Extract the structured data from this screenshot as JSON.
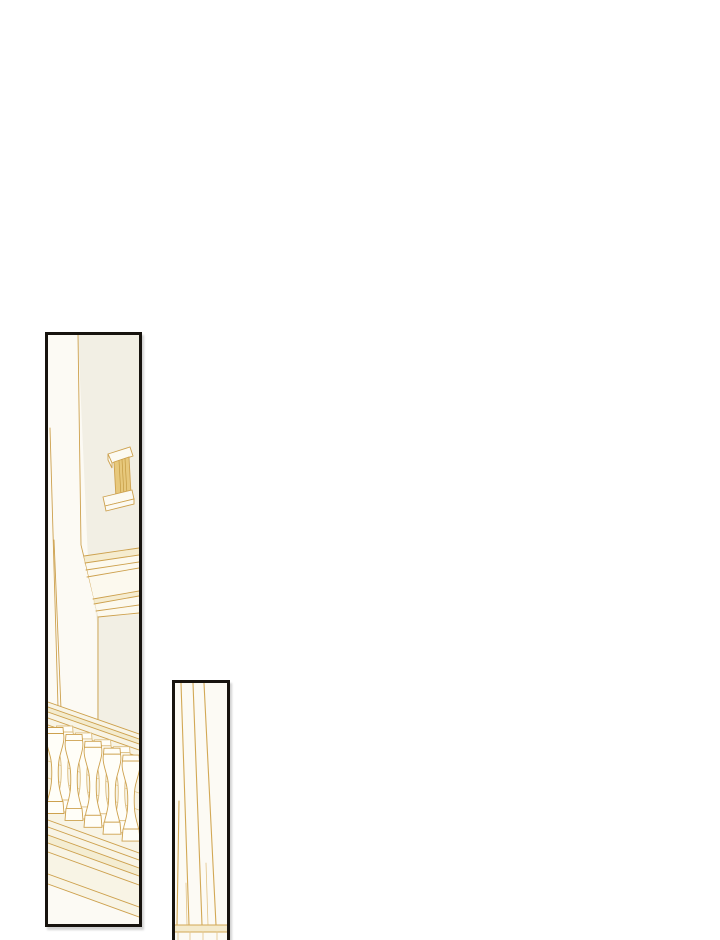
{
  "page": {
    "background": "#ffffff",
    "width": 720,
    "height": 940,
    "kind": "comic-page",
    "text_content": ""
  },
  "colors": {
    "panel_border": "#17130e",
    "gold": "#cda14e",
    "gold_light": "#e2c488",
    "wash": "#eedfb0",
    "wall": "#f2efe4",
    "zone": "#f8f4e5",
    "door": "#fcfaf4",
    "cornice_fill": "#fcf9ee",
    "baluster_fill": "#fffef8",
    "handle_fill": "#e7c87c",
    "hatch": "#c49b43"
  },
  "panels": {
    "left": {
      "alt": "door-edge-cornice-and-balustrade-line-art",
      "x": 45,
      "y": 332,
      "w": 97,
      "h": 595,
      "viewBox": "0 0 91 589",
      "stroke_default": "#cda14e",
      "width_default": 0.9,
      "art": [
        {
          "t": "poly",
          "p": "30,0 91,0 91,399 49,384 49,287 40,225",
          "f": "#f2efe4",
          "ns": true
        },
        {
          "t": "path",
          "d": "M30,0 L33,210 L50,280 L50,384"
        },
        {
          "t": "line",
          "p": [
            2,
            93,
            10,
            372
          ]
        },
        {
          "t": "line",
          "p": [
            6,
            205,
            13,
            374
          ]
        },
        {
          "t": "poly",
          "p": "36,221 91,213 91,279 50,282",
          "f": "#fcf9ee",
          "ns": true
        },
        {
          "t": "poly",
          "p": "36,221 91,213 91,220 37,228",
          "f": "#eedfb0",
          "o": 0.5,
          "ns": true
        },
        {
          "t": "poly",
          "p": "45,264 91,256 91,261 46,269",
          "f": "#eedfb0",
          "o": 0.5,
          "ns": true
        },
        {
          "t": "line",
          "p": [
            36,
            221,
            91,
            213
          ]
        },
        {
          "t": "line",
          "p": [
            37,
            228,
            91,
            220
          ]
        },
        {
          "t": "line",
          "p": [
            38,
            235,
            91,
            227
          ]
        },
        {
          "t": "line",
          "p": [
            39,
            242,
            91,
            233
          ]
        },
        {
          "t": "line",
          "p": [
            45,
            264,
            91,
            256
          ]
        },
        {
          "t": "line",
          "p": [
            46,
            269,
            91,
            261
          ]
        },
        {
          "t": "line",
          "p": [
            48,
            276,
            91,
            270
          ]
        },
        {
          "t": "line",
          "p": [
            50,
            282,
            91,
            278
          ]
        },
        {
          "t": "path",
          "d": "M60,119 L82,112 L85,121 L64,128 Z",
          "f": "#fcfaf2"
        },
        {
          "t": "path",
          "d": "M60,119 L60,125 L64,133 L64,128 Z",
          "f": "#fcfaf2"
        },
        {
          "t": "path",
          "d": "M66,127 L81,122 L83,159 L68,163 Z",
          "f": "#e7c87c"
        },
        {
          "t": "line",
          "p": [
            71,
            125.5,
            73,
            161.5
          ],
          "s": "#c49b43",
          "w": 0.7
        },
        {
          "t": "line",
          "p": [
            74,
            124.5,
            76,
            160.8
          ],
          "s": "#c49b43",
          "w": 0.7
        },
        {
          "t": "line",
          "p": [
            77,
            123.5,
            79,
            160
          ],
          "s": "#c49b43",
          "w": 0.7
        },
        {
          "t": "path",
          "d": "M55,162 L84,155 L86,164 L57,171 Z",
          "f": "#fcfaf2"
        },
        {
          "t": "path",
          "d": "M57,171 L86,164 L86,169 L58,176 Z",
          "f": "#fcfaf2"
        },
        {
          "t": "poly",
          "p": "0,367 91,399 91,582 0,549",
          "f": "#f8f4e5",
          "ns": true
        },
        {
          "t": "poly",
          "p": "0,372 91,404 91,409 0,377",
          "f": "#eedfb0",
          "o": 0.45,
          "ns": true
        },
        {
          "t": "line",
          "p": [
            0,
            367,
            91,
            399
          ]
        },
        {
          "t": "line",
          "p": [
            0,
            372,
            91,
            404
          ]
        },
        {
          "t": "line",
          "p": [
            0,
            377,
            91,
            409
          ]
        },
        {
          "t": "line",
          "p": [
            0,
            383,
            91,
            415
          ]
        },
        {
          "t": "line",
          "p": [
            0,
            390,
            91,
            422
          ]
        },
        {
          "t": "line",
          "p": [
            0,
            426,
            91,
            458
          ],
          "s": "#e2c488",
          "w": 0.7
        },
        {
          "t": "line",
          "p": [
            0,
            443,
            91,
            475
          ],
          "s": "#e2c488",
          "w": 0.7
        },
        {
          "t": "line",
          "p": [
            0,
            461,
            91,
            493
          ],
          "s": "#e2c488",
          "w": 0.7
        },
        {
          "t": "poly",
          "p": "0,500 91,533 91,541 0,508",
          "f": "#eedfb0",
          "o": 0.35,
          "ns": true
        },
        {
          "t": "line",
          "p": [
            0,
            485,
            91,
            518
          ]
        },
        {
          "t": "line",
          "p": [
            0,
            492,
            91,
            525
          ]
        },
        {
          "t": "line",
          "p": [
            0,
            500,
            91,
            533
          ]
        },
        {
          "t": "line",
          "p": [
            0,
            508,
            91,
            541
          ]
        },
        {
          "t": "line",
          "p": [
            0,
            517,
            91,
            550
          ]
        },
        {
          "t": "line",
          "p": [
            0,
            539,
            91,
            572
          ]
        },
        {
          "t": "line",
          "p": [
            0,
            549,
            91,
            582
          ]
        }
      ],
      "balusters": {
        "shape": {
          "cap": "M-8,0 L8,0 L8.5,6 L-8.5,6 Z",
          "body": "M-8.5,6 C-10,13 -7,20 -4.5,30 C-3.2,36 -3,44 -3.4,52 C-3.7,60 -5.5,66 -7,71 L-7.5,74 L7.5,74 L7,71 C5.5,66 3.7,60 3.4,52 C3,44 3.2,36 4.5,30 C7,20 10,13 8.5,6 Z",
          "foot": "M-8,74 L8,74 L9,86 L-9,86 Z"
        },
        "fill": "#fffef8",
        "front_stroke": "#cda14e",
        "back_stroke": "#dcbd80",
        "front": [
          {
            "cx": 7,
            "cy": 392.5
          },
          {
            "cx": 26,
            "cy": 399.4
          },
          {
            "cx": 45,
            "cy": 406.3
          },
          {
            "cx": 64,
            "cy": 413.2
          },
          {
            "cx": 83,
            "cy": 420.1
          }
        ],
        "back": [
          {
            "cx": 16.5,
            "cy": 391
          },
          {
            "cx": 35.5,
            "cy": 397.9
          },
          {
            "cx": 54.5,
            "cy": 404.8
          },
          {
            "cx": 73.5,
            "cy": 411.7
          }
        ]
      }
    },
    "right": {
      "alt": "column-vertical-lines-line-art",
      "x": 172,
      "y": 680,
      "w": 58,
      "h": 280,
      "viewBox": "0 0 52 274",
      "stroke_default": "#d2a855",
      "width_default": 1.1,
      "art": [
        {
          "t": "path",
          "d": "M4,118 L2,242"
        },
        {
          "t": "path",
          "d": "M6,0 L14,242"
        },
        {
          "t": "path",
          "d": "M18,0 L27,242"
        },
        {
          "t": "path",
          "d": "M29,0 L41,242"
        },
        {
          "t": "line",
          "p": [
            11,
            200,
            12,
            242
          ],
          "s": "#e2c488",
          "w": 0.8
        },
        {
          "t": "line",
          "p": [
            31,
            180,
            33,
            242
          ],
          "s": "#e2c488",
          "w": 0.8
        },
        {
          "t": "poly",
          "p": "0,242 52,242 52,249 0,249",
          "f": "#eedfb0",
          "o": 0.6,
          "ns": true
        },
        {
          "t": "line",
          "p": [
            0,
            242,
            52,
            242
          ]
        },
        {
          "t": "line",
          "p": [
            0,
            249,
            52,
            249
          ]
        },
        {
          "t": "line",
          "p": [
            3,
            249,
            3,
            274
          ],
          "s": "#e2c488",
          "w": 0.8
        },
        {
          "t": "line",
          "p": [
            15,
            249,
            15,
            274
          ],
          "s": "#e2c488",
          "w": 0.8
        },
        {
          "t": "line",
          "p": [
            28,
            249,
            28,
            274
          ],
          "s": "#e2c488",
          "w": 0.8
        },
        {
          "t": "line",
          "p": [
            42,
            249,
            42,
            274
          ],
          "s": "#e2c488",
          "w": 0.8
        }
      ],
      "balusters": null
    }
  }
}
